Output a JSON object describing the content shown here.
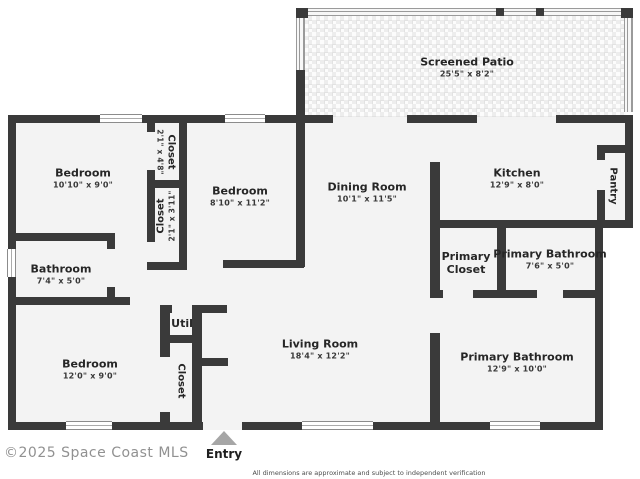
{
  "plan": {
    "screened_patio": {
      "name": "Screened Patio",
      "dims": "25'5\" x 8'2\""
    },
    "bedroom_left": {
      "name": "Bedroom",
      "dims": "10'10\" x 9'0\""
    },
    "closet_top": {
      "name": "Closet",
      "dims": "2'1\" x 4'8\""
    },
    "closet_mid": {
      "name": "Closet",
      "dims": "2'1\" x 3'11\""
    },
    "bedroom_mid": {
      "name": "Bedroom",
      "dims": "8'10\" x 11'2\""
    },
    "dining_room": {
      "name": "Dining Room",
      "dims": "10'1\" x 11'5\""
    },
    "kitchen": {
      "name": "Kitchen",
      "dims": "12'9\" x 8'0\""
    },
    "pantry": {
      "name": "Pantry"
    },
    "primary_closet": {
      "name": "Primary Closet"
    },
    "primary_bathroom_small": {
      "name": "Primary Bathroom",
      "dims": "7'6\" x 5'0\""
    },
    "bathroom": {
      "name": "Bathroom",
      "dims": "7'4\" x 5'0\""
    },
    "bedroom_bottom": {
      "name": "Bedroom",
      "dims": "12'0\" x 9'0\""
    },
    "util": {
      "name": "Util"
    },
    "closet_bottom": {
      "name": "Closet"
    },
    "living_room": {
      "name": "Living Room",
      "dims": "18'4\" x 12'2\""
    },
    "primary_bathroom_large": {
      "name": "Primary Bathroom",
      "dims": "12'9\" x 10'0\""
    },
    "entry": {
      "label": "Entry"
    }
  },
  "footer": {
    "watermark": "©2025 Space Coast MLS",
    "disclaimer": "All dimensions are approximate and subject to independent verification"
  }
}
